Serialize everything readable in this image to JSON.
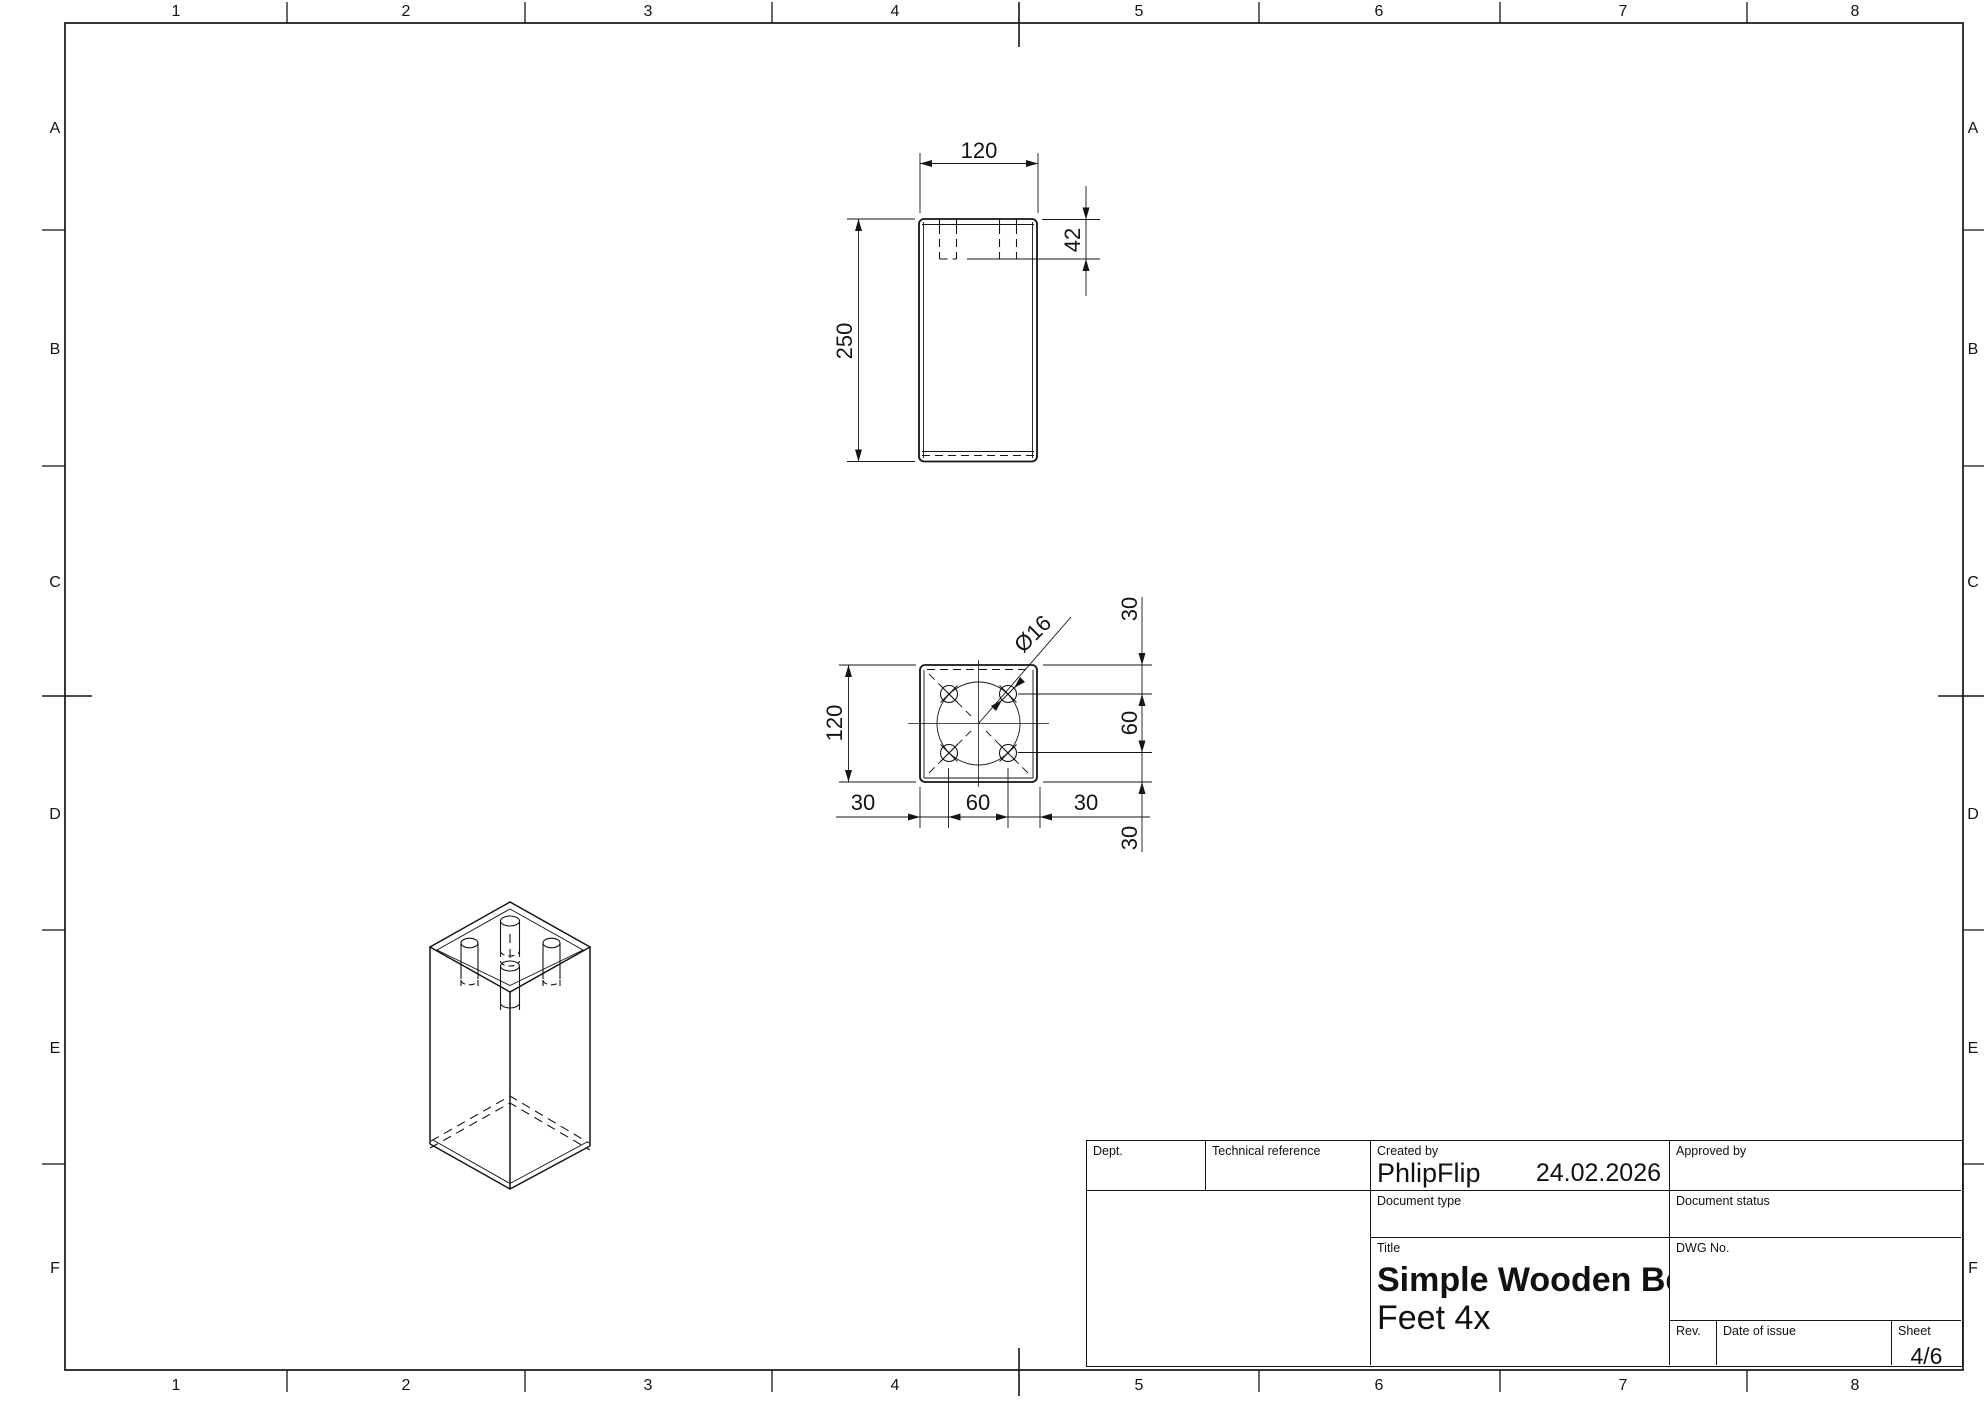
{
  "sheet": {
    "zones": {
      "cols": [
        "1",
        "2",
        "3",
        "4",
        "5",
        "6",
        "7",
        "8"
      ],
      "rows": [
        "A",
        "B",
        "C",
        "D",
        "E",
        "F"
      ]
    }
  },
  "views": {
    "front": {
      "width": "120",
      "height": "250",
      "hole_depth": "42"
    },
    "top": {
      "size": "120",
      "hole_dia": "Ø16",
      "right_chain": [
        "30",
        "60",
        "30"
      ],
      "bottom_chain": [
        "30",
        "60",
        "30"
      ]
    }
  },
  "title_block": {
    "dept_label": "Dept.",
    "technical_reference_label": "Technical reference",
    "created_by_label": "Created by",
    "created_by": "PhlipFlip",
    "date": "24.02.2026",
    "approved_by_label": "Approved by",
    "document_type_label": "Document type",
    "document_status_label": "Document status",
    "title_label": "Title",
    "title_line1": "Simple Wooden Bed",
    "title_line2": "Feet 4x",
    "dwg_no_label": "DWG No.",
    "rev_label": "Rev.",
    "date_of_issue_label": "Date of issue",
    "sheet_label": "Sheet",
    "sheet_value": "4/6"
  },
  "colors": {
    "line": "#151515",
    "background": "#ffffff"
  }
}
